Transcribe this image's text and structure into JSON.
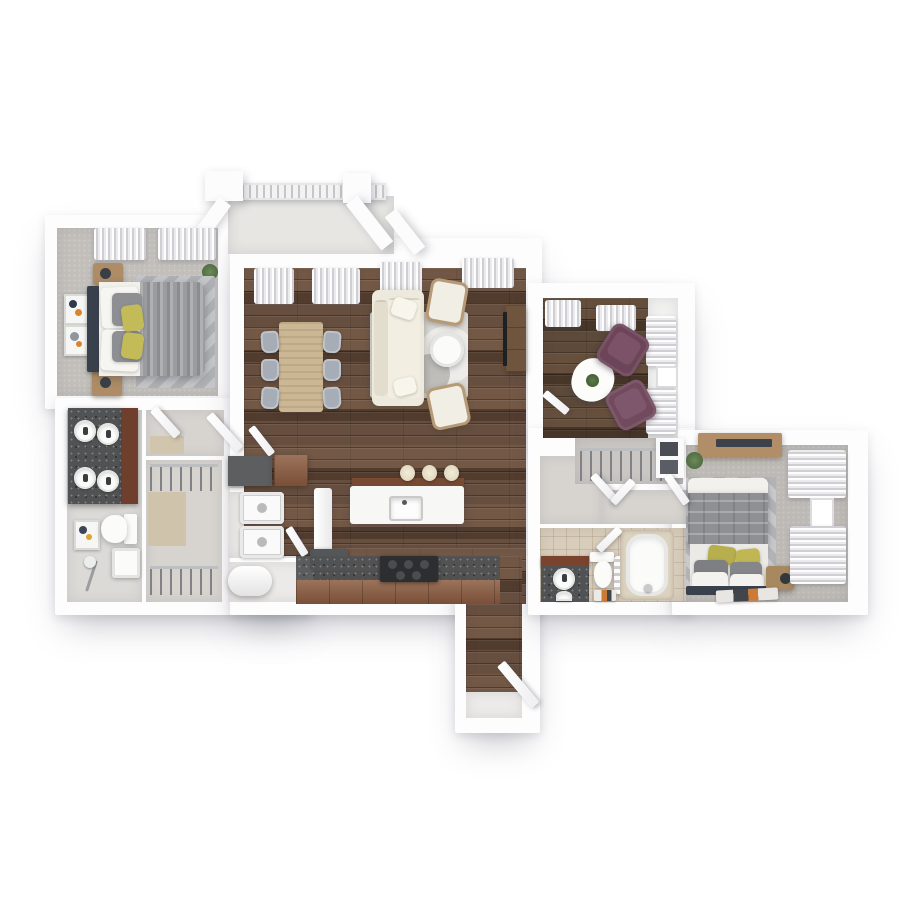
{
  "canvas": {
    "width": 900,
    "height": 900,
    "background": "#ffffff"
  },
  "plan_type": "3d-apartment-floor-plan-top-down-render",
  "rooms": {
    "bedroom1": {
      "name": "bedroom 1",
      "floor": "gray carpet",
      "furniture": [
        "double bed",
        "dark headboard",
        "gray duvet",
        "white pillows",
        "gray pillows",
        "yellow accent pillows",
        "wood nightstand x2",
        "table lamps",
        "wall art x2",
        "striped gray rug",
        "window curtains",
        "potted plant"
      ]
    },
    "bathroom1": {
      "name": "bathroom 1",
      "floor": "light gray tile",
      "furniture": [
        "dark speckled double vanity",
        "round vessel sinks x4",
        "wood cabinet",
        "toilet",
        "shower with handheld sprayer",
        "wall art"
      ]
    },
    "walk_in_closet": {
      "name": "walk-in closet",
      "floor": "gray + beige tile",
      "furniture": [
        "hanging rail top",
        "hanging rail bottom"
      ]
    },
    "laundry_utility": {
      "name": "laundry / utility",
      "floor": "light tile",
      "furniture": [
        "dark cabinet",
        "wood cabinet",
        "stacked washer",
        "stacked dryer",
        "water heater cylinder"
      ]
    },
    "balcony": {
      "name": "balcony",
      "floor": "concrete",
      "furniture": [
        "lattice railing",
        "angled wing walls",
        "columns"
      ]
    },
    "living_dining": {
      "name": "living / dining room",
      "floor": "walnut plank wood",
      "furniture": [
        "light oak dining table",
        "gray dining chairs x6",
        "cream sofa",
        "accent chairs x2",
        "round white coffee table",
        "light area rug with circle motif",
        "wood tv console",
        "tv",
        "window curtains"
      ]
    },
    "kitchen": {
      "name": "kitchen",
      "floor": "walnut plank wood",
      "furniture": [
        "white island with sink",
        "canisters x3",
        "speckled counter run",
        "wood base cabinets",
        "dark cooktop",
        "dark appliance",
        "white fridge"
      ]
    },
    "entry_hall": {
      "name": "entry hallway",
      "floor": "walnut plank wood + white threshold",
      "furniture": [
        "entry door leaf"
      ]
    },
    "den": {
      "name": "den / study",
      "floor": "dark walnut wood",
      "furniture": [
        "plum armchair x2",
        "white organic coffee table",
        "small plant",
        "window curtains"
      ]
    },
    "hall_closet": {
      "name": "hall + reach-in closet",
      "floor": "gray tile",
      "furniture": [
        "hanging rail",
        "bifold doors",
        "white shelf unit"
      ]
    },
    "bathroom2": {
      "name": "bathroom 2",
      "floor": "beige tile",
      "furniture": [
        "wood-front vanity with dark counter",
        "round sinks",
        "toilet",
        "towel ladder",
        "bathtub",
        "striped bath mat"
      ]
    },
    "bedroom2": {
      "name": "bedroom 2",
      "floor": "gray carpet",
      "furniture": [
        "double bed",
        "quilted gray duvet",
        "yellow accent pillows",
        "gray pillows",
        "white pillows",
        "dark headboard",
        "wood nightstand with lamp",
        "wood dresser shelf",
        "chevron rug",
        "striped floor mat",
        "window curtains",
        "potted plant"
      ]
    }
  },
  "palette": {
    "wall": "#ffffff",
    "wood_floor": "#5f4636",
    "wood_floor_dark": "#54402f",
    "carpet_gray": "#c2bfbb",
    "tile_gray": "#dcdad7",
    "tile_beige": "#d8cdbb",
    "balcony_concrete": "#e7e6e3",
    "counter_dark": "#505254",
    "cabinet_wood": "#8a5a3e",
    "oak_light": "#ccb795",
    "sofa_cream": "#ede9dc",
    "chair_gray": "#a6adb6",
    "armchair_plum": "#6d4559",
    "pillow_yellow": "#c3ba58",
    "headboard_dark": "#39414d",
    "mat_orange": "#cb7b36",
    "plant_green": "#5e7a4c",
    "curtain": "#e9e9ec"
  }
}
